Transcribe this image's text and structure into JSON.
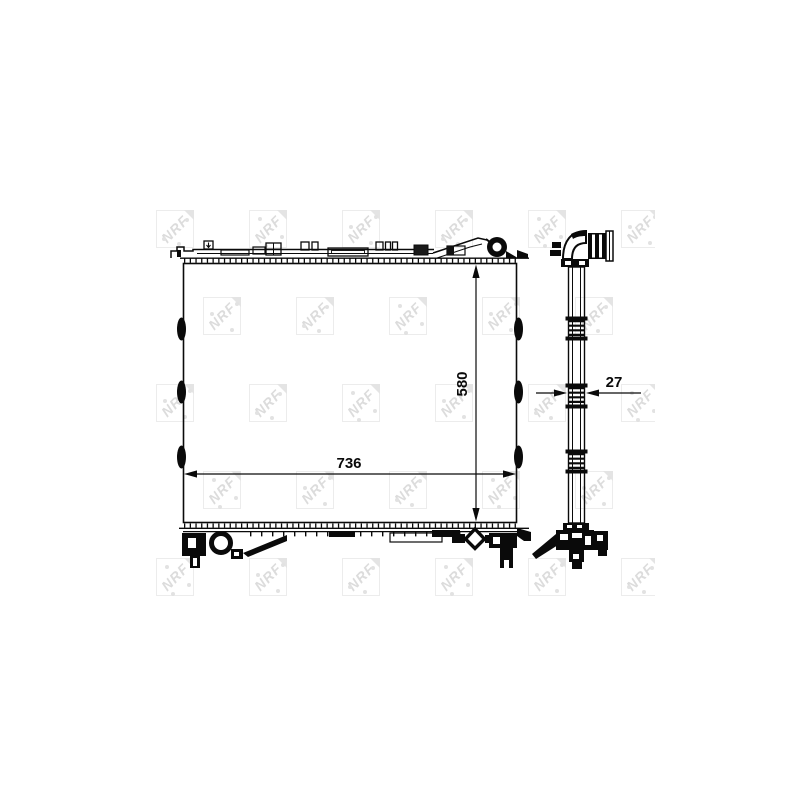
{
  "colors": {
    "background": "#ffffff",
    "line": "#0a0a0a",
    "watermark": "#dcdcdc"
  },
  "dimensions": {
    "width_label": "736",
    "height_label": "580",
    "depth_label": "27"
  },
  "watermark": {
    "text": "NRF"
  }
}
